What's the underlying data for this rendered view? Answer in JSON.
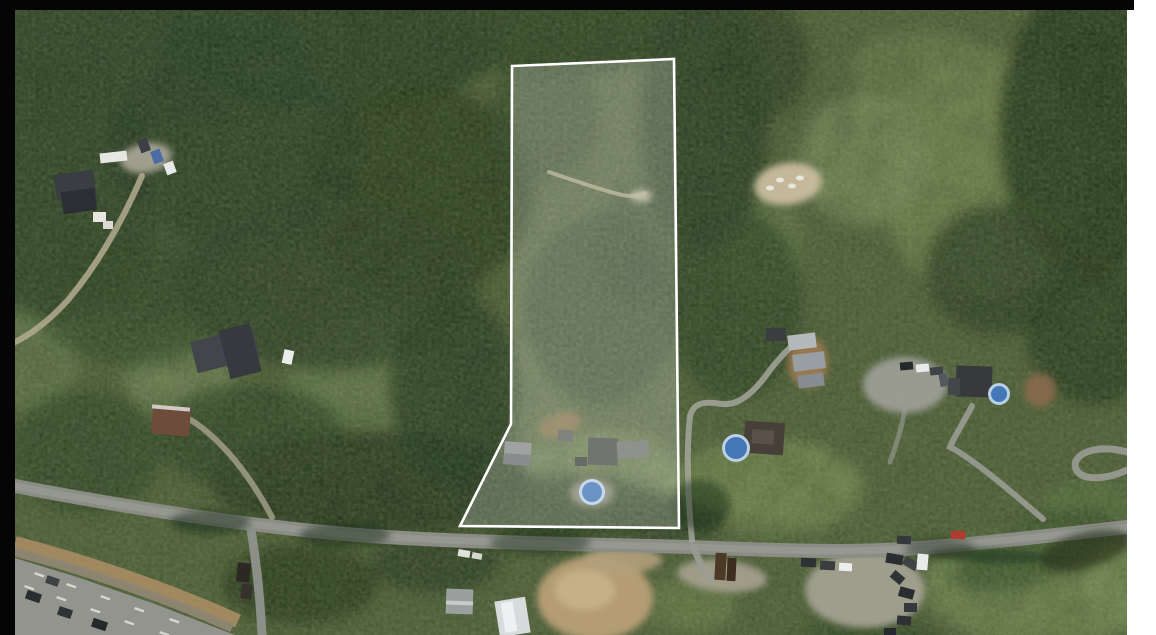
{
  "meta": {
    "view_type": "satellite-aerial-photo",
    "subject": "rural treed acreage with white-outlined property parcel, road along bottom and highway at lower left"
  },
  "scene": {
    "base_color": "#55653e",
    "parcel": {
      "points": "512,66 674,59 679,528 460,526 511,424",
      "stroke": "#ffffff",
      "stroke_width": 2.6,
      "fill": "rgba(255,255,255,0.21)"
    },
    "meadows": [
      [
        985,
        175,
        105,
        125,
        0,
        "#7e9158",
        0.9
      ],
      [
        865,
        160,
        65,
        65,
        0,
        "#859763",
        0.85
      ],
      [
        920,
        70,
        70,
        40,
        0,
        "#748853",
        0.7
      ],
      [
        370,
        390,
        85,
        75,
        0,
        "#75895a",
        0.75
      ],
      [
        180,
        382,
        55,
        42,
        0,
        "#7c8f5e",
        0.8
      ],
      [
        600,
        472,
        85,
        42,
        0,
        "#7b8e5a",
        0.8
      ],
      [
        770,
        487,
        95,
        48,
        0,
        "#7f9257",
        0.9
      ],
      [
        1040,
        587,
        115,
        60,
        0,
        "#7a8e55",
        0.95
      ],
      [
        690,
        606,
        45,
        28,
        0,
        "#748850",
        0.8
      ],
      [
        128,
        192,
        52,
        42,
        0,
        "#6f8354",
        0.75
      ],
      [
        38,
        352,
        42,
        65,
        0,
        "#6d8151",
        0.7
      ],
      [
        763,
        245,
        42,
        55,
        0,
        "#6c8050",
        0.7
      ],
      [
        540,
        390,
        40,
        50,
        0,
        "#6a7e4e",
        0.5
      ],
      [
        92,
        118,
        42,
        30,
        0,
        "#647850",
        0.6
      ],
      [
        240,
        330,
        40,
        30,
        0,
        "#62764a",
        0.5
      ],
      [
        1118,
        600,
        32,
        32,
        0,
        "#84975e",
        0.85
      ],
      [
        1090,
        505,
        45,
        25,
        0,
        "#5f7a42",
        0.85
      ]
    ],
    "forest": [
      [
        120,
        55,
        190,
        75,
        0,
        "#283c21",
        0.9
      ],
      [
        330,
        45,
        170,
        65,
        0,
        "#243720",
        0.9
      ],
      [
        555,
        28,
        130,
        48,
        0,
        "#2a3d22",
        0.85
      ],
      [
        60,
        190,
        100,
        130,
        0,
        "#2a3e22",
        0.9
      ],
      [
        235,
        150,
        130,
        95,
        0,
        "#253821",
        0.85
      ],
      [
        150,
        265,
        75,
        55,
        0,
        "#2e4226",
        0.7
      ],
      [
        420,
        190,
        115,
        105,
        0,
        "#233619",
        0.85
      ],
      [
        330,
        285,
        150,
        85,
        0,
        "#253821",
        0.8
      ],
      [
        135,
        305,
        95,
        60,
        0,
        "#2c4023",
        0.65
      ],
      [
        455,
        390,
        65,
        95,
        0,
        "#243720",
        0.85
      ],
      [
        370,
        482,
        160,
        52,
        0,
        "#1f3019",
        0.85
      ],
      [
        560,
        507,
        110,
        32,
        0,
        "#22341c",
        0.8
      ],
      [
        705,
        120,
        65,
        130,
        0,
        "#243720",
        0.85
      ],
      [
        760,
        60,
        50,
        60,
        0,
        "#223518",
        0.7
      ],
      [
        735,
        305,
        68,
        95,
        0,
        "#283c21",
        0.75
      ],
      [
        1085,
        130,
        85,
        150,
        0,
        "#1f3019",
        0.9
      ],
      [
        1000,
        270,
        75,
        65,
        0,
        "#273a20",
        0.8
      ],
      [
        1095,
        330,
        70,
        75,
        0,
        "#223419",
        0.8
      ],
      [
        600,
        310,
        75,
        95,
        0,
        "#2c4024",
        0.65
      ],
      [
        545,
        118,
        55,
        62,
        0,
        "#2e4226",
        0.65
      ],
      [
        640,
        245,
        45,
        60,
        0,
        "#2b3f23",
        0.6
      ],
      [
        250,
        437,
        95,
        52,
        0,
        "#283c21",
        0.75
      ],
      [
        85,
        452,
        75,
        62,
        0,
        "#2a3e22",
        0.7
      ],
      [
        435,
        562,
        65,
        32,
        0,
        "#26391f",
        0.8
      ],
      [
        300,
        584,
        78,
        40,
        0,
        "#233519",
        0.85
      ],
      [
        672,
        522,
        55,
        22,
        0,
        "#22341c",
        0.7
      ],
      [
        1035,
        550,
        85,
        32,
        -20,
        "#2b3f23",
        0.55
      ],
      [
        870,
        640,
        70,
        25,
        0,
        "#2a3e22",
        0.6
      ]
    ],
    "shadows": [
      [
        210,
        522,
        40,
        12,
        0,
        "#1c2a16",
        0.5
      ],
      [
        345,
        535,
        45,
        12,
        0,
        "#1c2a16",
        0.5
      ],
      [
        540,
        543,
        50,
        12,
        0,
        "#1c2a16",
        0.45
      ],
      [
        940,
        548,
        35,
        10,
        0,
        "#1c2a16",
        0.4
      ],
      [
        700,
        505,
        30,
        25,
        0,
        "#1c2a16",
        0.45
      ],
      [
        1085,
        550,
        45,
        18,
        -15,
        "#1c2a16",
        0.55
      ],
      [
        990,
        556,
        60,
        7,
        2,
        "#22351c",
        0.6
      ]
    ],
    "dirt": [
      [
        788,
        184,
        34,
        21,
        -8,
        "#c9bd9e",
        0.95
      ],
      [
        595,
        598,
        58,
        42,
        0,
        "#b49c74",
        1
      ],
      [
        585,
        590,
        30,
        20,
        0,
        "#c8b289",
        0.9
      ],
      [
        622,
        560,
        40,
        13,
        0,
        "#b2a07c",
        0.9
      ],
      [
        146,
        158,
        26,
        15,
        -10,
        "#a5a294",
        0.95
      ],
      [
        905,
        385,
        42,
        28,
        0,
        "#9d9e96",
        0.95
      ],
      [
        865,
        590,
        60,
        38,
        0,
        "#a3a191",
        0.95
      ],
      [
        722,
        576,
        45,
        16,
        5,
        "#a7a290",
        0.9
      ],
      [
        1040,
        390,
        16,
        17,
        0,
        "#8a6a4c",
        0.9
      ],
      [
        808,
        362,
        20,
        26,
        0,
        "#9d7a52",
        0.9
      ],
      [
        560,
        425,
        22,
        12,
        -15,
        "#96794f",
        0.7
      ],
      [
        641,
        196,
        11,
        6,
        0,
        "#c9c2a4",
        0.85
      ],
      [
        592,
        493,
        22,
        14,
        0,
        "#908c80",
        0.9
      ]
    ],
    "roads": [
      {
        "d": "M15,486 C130,508 250,527 370,536 C480,543 580,544 690,547 C740,549 790,551 840,551 C920,551 1020,539 1127,527",
        "w": 14,
        "c": "#8b8d85",
        "o": 1
      },
      {
        "d": "M15,486 C130,508 250,527 370,536 C480,543 580,544 690,547 C740,549 790,551 840,551 C920,551 1020,539 1127,527",
        "w": 7,
        "c": "#9da099",
        "o": 0.6
      },
      {
        "d": "M1043,519 C1015,495 975,460 950,447 C955,435 965,420 972,406",
        "w": 6,
        "c": "#9a9c94",
        "o": 0.9
      },
      {
        "d": "M1127,452 C1095,443 1070,455 1076,469 C1082,482 1108,479 1127,470",
        "w": 7,
        "c": "#9a9c94",
        "o": 0.9
      },
      {
        "d": "M692,540 C688,500 686,452 690,416 C694,400 710,402 722,404 C740,406 756,390 770,370 C778,360 786,351 793,345",
        "w": 6,
        "c": "#a3a69c",
        "o": 0.85
      },
      {
        "d": "M142,176 C125,215 100,262 68,300 C50,320 30,335 15,342",
        "w": 6,
        "c": "#b3ab91",
        "o": 0.85
      },
      {
        "d": "M272,517 C255,485 230,448 197,424 C190,419 183,416 176,414",
        "w": 6,
        "c": "#a8a28c",
        "o": 0.8
      },
      {
        "d": "M251,529 C256,560 260,595 262,635",
        "w": 9,
        "c": "#90928c",
        "o": 0.95
      },
      {
        "d": "M694,548 C699,562 704,572 712,580",
        "w": 7,
        "c": "#9a9c94",
        "o": 0.9
      },
      {
        "d": "M905,408 C902,428 896,446 890,462",
        "w": 5,
        "c": "#9a9c94",
        "o": 0.6
      }
    ],
    "trails": [
      {
        "d": "M549,172 C572,180 598,189 622,195 C633,197 640,196 645,193",
        "w": 4,
        "c": "#b5ae8e",
        "o": 0.75
      }
    ],
    "highway": {
      "poly": "15,558 80,578 155,604 235,635 15,635",
      "color": "#92948d",
      "dirt_path": "M15,543 C80,560 160,586 238,621",
      "dirt_color": "#a98d63",
      "rock_path": "M15,552 C80,569 158,595 232,628",
      "rock_color": "#8e8672",
      "dash_rot": 19,
      "dash_color": "#e3e4de",
      "dashes": [
        [
          25,
          585
        ],
        [
          57,
          596
        ],
        [
          91,
          608
        ],
        [
          125,
          620
        ],
        [
          160,
          631
        ],
        [
          35,
          572
        ],
        [
          67,
          583
        ],
        [
          101,
          595
        ],
        [
          135,
          607
        ],
        [
          170,
          618
        ]
      ]
    },
    "buildings": [
      [
        55,
        172,
        40,
        26,
        -8,
        "#3a3e42"
      ],
      [
        62,
        190,
        34,
        22,
        -8,
        "#2b2f33"
      ],
      [
        100,
        152,
        27,
        10,
        -6,
        "#e6e7e3"
      ],
      [
        93,
        212,
        13,
        10,
        0,
        "#e9e7df"
      ],
      [
        103,
        221,
        10,
        8,
        0,
        "#dcdad2"
      ],
      [
        193,
        334,
        64,
        32,
        -14,
        "#42464a"
      ],
      [
        224,
        326,
        32,
        50,
        -14,
        "#36393d"
      ],
      [
        152,
        406,
        38,
        29,
        5,
        "#6e4c3c"
      ],
      [
        152,
        406,
        38,
        4,
        5,
        "#cfcac2"
      ],
      [
        504,
        442,
        27,
        23,
        4,
        "#87898a"
      ],
      [
        504,
        454,
        27,
        11,
        4,
        "#6a6c6d"
      ],
      [
        588,
        438,
        30,
        27,
        2,
        "#4b4f4a"
      ],
      [
        617,
        441,
        32,
        17,
        -4,
        "#70746e"
      ],
      [
        558,
        430,
        15,
        11,
        6,
        "#5d615b"
      ],
      [
        575,
        457,
        12,
        9,
        0,
        "#3f433e"
      ],
      [
        744,
        422,
        40,
        32,
        4,
        "#474039"
      ],
      [
        752,
        430,
        22,
        14,
        4,
        "#5a5249"
      ],
      [
        788,
        334,
        28,
        15,
        -7,
        "#b4b9bc"
      ],
      [
        793,
        353,
        32,
        17,
        -7,
        "#989ea2"
      ],
      [
        798,
        374,
        26,
        13,
        -7,
        "#878c90"
      ],
      [
        766,
        328,
        20,
        13,
        0,
        "#3a3e41"
      ],
      [
        956,
        366,
        36,
        31,
        2,
        "#37393c"
      ],
      [
        948,
        378,
        12,
        17,
        2,
        "#44474a"
      ],
      [
        446,
        589,
        27,
        25,
        2,
        "#9b9f9e"
      ],
      [
        446,
        601,
        27,
        4,
        2,
        "#c8ccca"
      ],
      [
        497,
        599,
        31,
        36,
        -9,
        "#d8dbdc"
      ],
      [
        503,
        602,
        12,
        30,
        -9,
        "#eef0f1"
      ],
      [
        715,
        553,
        11,
        27,
        3,
        "#4c3a27"
      ],
      [
        727,
        558,
        9,
        23,
        3,
        "#3c2f20"
      ],
      [
        237,
        563,
        13,
        19,
        6,
        "#2c2822"
      ],
      [
        241,
        584,
        11,
        15,
        6,
        "#37322b"
      ]
    ],
    "pool_colors": {
      "ring": "#b9d0e6",
      "fill": "#4477b5"
    },
    "pools": [
      [
        592,
        492,
        10
      ],
      [
        736,
        448,
        11
      ],
      [
        999,
        394,
        8
      ]
    ],
    "vehicles": [
      [
        139,
        139,
        10,
        13,
        -20,
        "#3b3e45"
      ],
      [
        152,
        150,
        10,
        13,
        -20,
        "#4a6da5"
      ],
      [
        165,
        162,
        10,
        12,
        -20,
        "#e7e9e9"
      ],
      [
        283,
        350,
        10,
        14,
        12,
        "#ebedeb"
      ],
      [
        801,
        558,
        15,
        9,
        3,
        "#2e3134"
      ],
      [
        820,
        561,
        15,
        9,
        3,
        "#3b3e41"
      ],
      [
        839,
        563,
        13,
        8,
        3,
        "#eceeee"
      ],
      [
        897,
        536,
        14,
        8,
        2,
        "#34373b"
      ],
      [
        951,
        531,
        14,
        8,
        2,
        "#b23a2e"
      ],
      [
        886,
        554,
        17,
        10,
        10,
        "#2b2e31"
      ],
      [
        903,
        559,
        15,
        9,
        30,
        "#3f4245"
      ],
      [
        917,
        554,
        11,
        16,
        5,
        "#e9ebeb"
      ],
      [
        891,
        573,
        13,
        9,
        40,
        "#303336"
      ],
      [
        899,
        588,
        15,
        10,
        15,
        "#2a2d30"
      ],
      [
        904,
        603,
        13,
        9,
        0,
        "#35383c"
      ],
      [
        897,
        616,
        14,
        9,
        5,
        "#2e3134"
      ],
      [
        884,
        628,
        12,
        8,
        0,
        "#26292d"
      ],
      [
        900,
        362,
        13,
        8,
        -5,
        "#26292c"
      ],
      [
        916,
        364,
        13,
        8,
        -5,
        "#e9ebeb"
      ],
      [
        930,
        367,
        13,
        8,
        -5,
        "#3f4246"
      ],
      [
        937,
        376,
        13,
        8,
        80,
        "#54575b"
      ],
      [
        26,
        592,
        15,
        9,
        19,
        "#2a2d30"
      ],
      [
        58,
        608,
        14,
        9,
        19,
        "#303336"
      ],
      [
        92,
        620,
        15,
        9,
        19,
        "#26292c"
      ],
      [
        46,
        577,
        13,
        8,
        19,
        "#3f4245"
      ],
      [
        458,
        550,
        12,
        7,
        10,
        "#dfe1dd"
      ],
      [
        472,
        553,
        10,
        6,
        10,
        "#d4d6d2"
      ]
    ],
    "speckles": [
      [
        780,
        180
      ],
      [
        792,
        186
      ],
      [
        800,
        178
      ],
      [
        770,
        188
      ]
    ]
  },
  "frame": {
    "bar_color": "#050505",
    "panel_color": "#ffffff"
  }
}
